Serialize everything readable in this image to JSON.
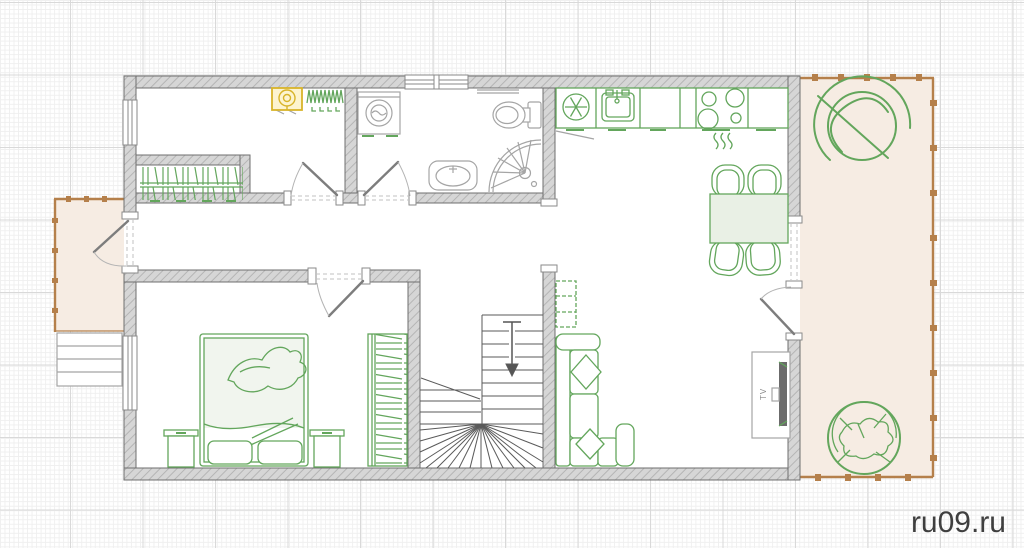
{
  "page": {
    "type": "house-floor-plan-drawing",
    "width_px": 1024,
    "height_px": 548
  },
  "watermark": {
    "text": "RU09.RU"
  },
  "branding": {
    "site_label": "ru09.ru"
  },
  "labels": {
    "tv": "TV"
  },
  "colors": {
    "furniture_green": "#63a65c",
    "furniture_green_fill": "#e9f0e5",
    "wall_fill": "#d6d6d6",
    "wall_hatch": "#b5b5b5",
    "wall_outline": "#6f6f6f",
    "fixture_gray": "#a5a5a5",
    "terrace_fill": "#f6ece3",
    "terrace_border": "#b5804b",
    "boiler_yellow": "#d8b42a",
    "boiler_fill": "#fdf4cf",
    "grid_minor": "#efefef",
    "grid_major": "#d9d9d9",
    "watermark_color": "#e7e7e7",
    "site_label_color": "#3f3f3f"
  },
  "symbols": [
    "boiler",
    "radiator",
    "hall-closet-shelving",
    "washing-machine",
    "toilet",
    "corner-shower",
    "bathroom-sink",
    "refrigerator-snowflake",
    "kitchen-sink",
    "cooktop-4-burner",
    "dining-table-4-chairs",
    "winder-staircase",
    "double-bed",
    "nightstand",
    "bedroom-wardrobe",
    "corner-sofa",
    "tv-stand",
    "wall-shelf",
    "potted-plant-terrace-top",
    "potted-plant-terrace-bottom",
    "porch-steps",
    "terrace-railing",
    "porch-railing"
  ]
}
